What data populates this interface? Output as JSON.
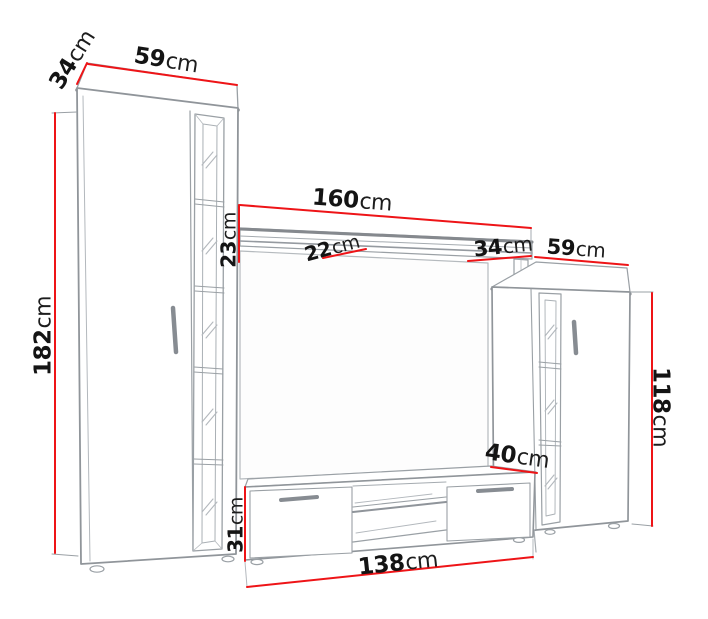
{
  "diagram": {
    "title": "TV wall unit dimension diagram",
    "unit": "cm",
    "accent_color": "#ee1417",
    "line_color": "#90959a",
    "text_color": "#141414",
    "labels": {
      "left_cabinet_depth": {
        "value": "34",
        "unit": "cm"
      },
      "left_cabinet_width": {
        "value": "59",
        "unit": "cm"
      },
      "left_cabinet_height": {
        "value": "182",
        "unit": "cm"
      },
      "shelf_width": {
        "value": "160",
        "unit": "cm"
      },
      "shelf_clearance": {
        "value": "23",
        "unit": "cm"
      },
      "shelf_depth": {
        "value": "22",
        "unit": "cm"
      },
      "right_cabinet_depth": {
        "value": "34",
        "unit": "cm"
      },
      "right_cabinet_width": {
        "value": "59",
        "unit": "cm"
      },
      "right_cabinet_height": {
        "value": "118",
        "unit": "cm"
      },
      "tv_stand_depth": {
        "value": "40",
        "unit": "cm"
      },
      "tv_stand_height": {
        "value": "31",
        "unit": "cm"
      },
      "tv_stand_width": {
        "value": "138",
        "unit": "cm"
      }
    }
  }
}
